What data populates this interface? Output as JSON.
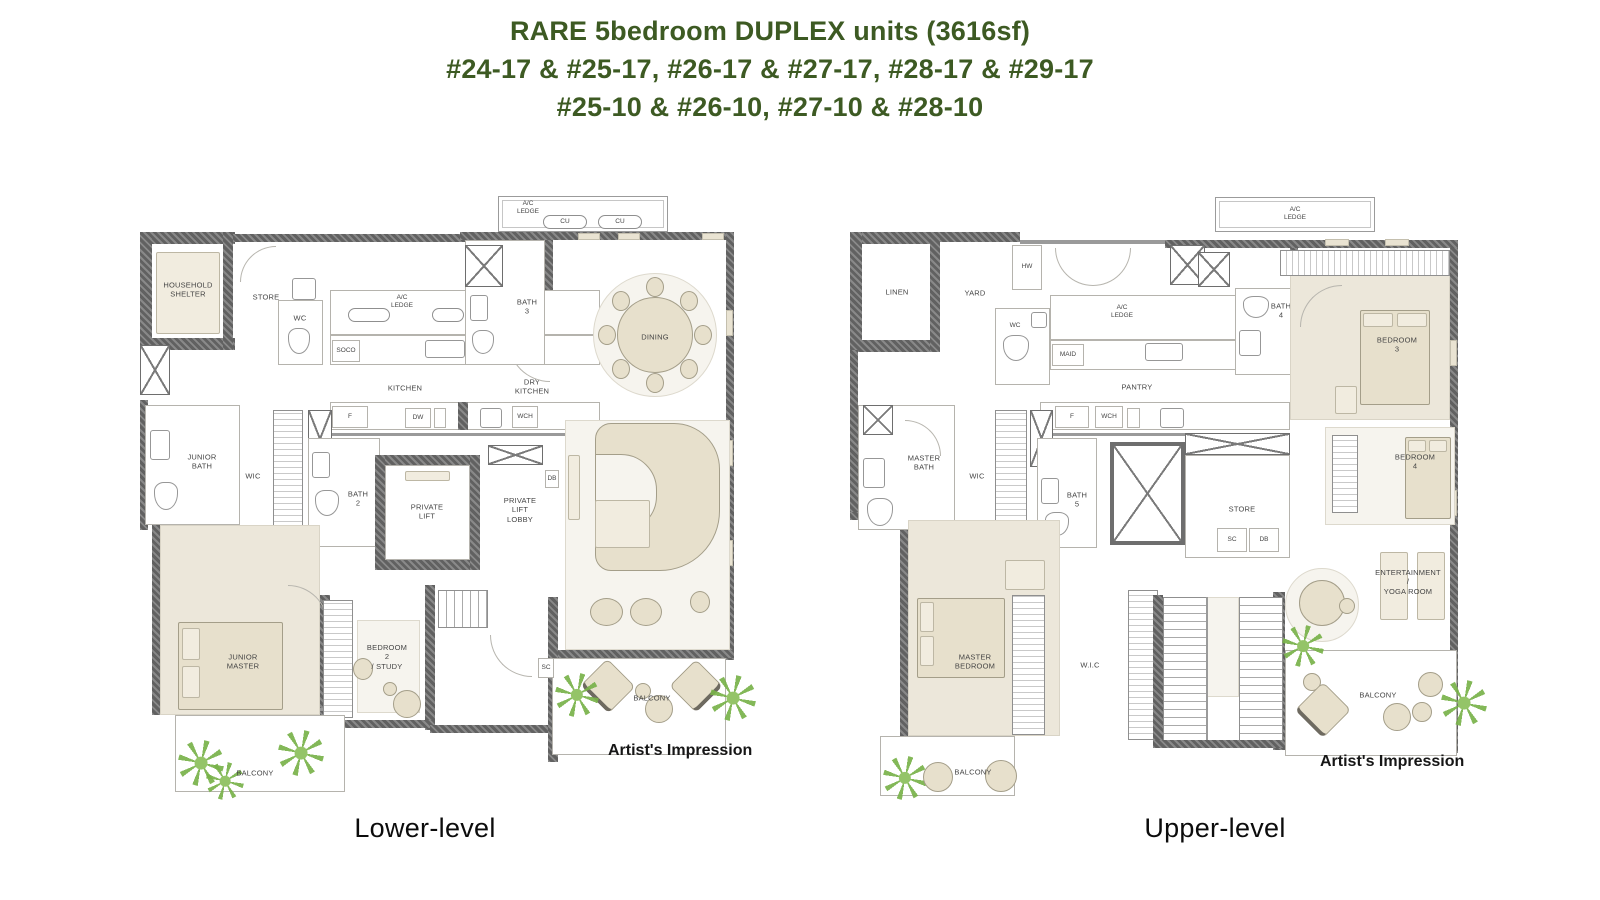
{
  "title": {
    "line1": "RARE 5bedroom DUPLEX units (3616sf)",
    "line2": "#24-17 & #25-17, #26-17 & #27-17, #28-17 & #29-17",
    "line3": "#25-10 & #26-10, #27-10 & #28-10"
  },
  "colors": {
    "title_green": "#3d5a23",
    "wall_gray": "#616161",
    "furniture_beige": "#e7e0cc",
    "floor_beige": "#ece7da",
    "plant_green": "#79b24a",
    "text_dark": "#111111"
  },
  "plans": {
    "lower": {
      "level_label": "Lower-level",
      "credit": "Artist's Impression",
      "rooms": {
        "household_shelter": "HOUSEHOLD\nSHELTER",
        "store": "STORE",
        "wc": "WC",
        "ac_ledge_top": "A/C\nLEDGE",
        "ac_ledge": "A/C\nLEDGE",
        "cu": "CU",
        "soco": "SOCO",
        "kitchen": "KITCHEN",
        "dry_kitchen": "DRY\nKITCHEN",
        "bath_3": "BATH\n3",
        "dining": "DINING",
        "junior_bath": "JUNIOR\nBATH",
        "wic": "WIC",
        "bath_2": "BATH\n2",
        "private_lift": "PRIVATE\nLIFT",
        "private_lift_lobby": "PRIVATE\nLIFT\nLOBBY",
        "db": "DB",
        "f": "F",
        "dw": "DW",
        "wch": "WCH",
        "sc": "SC",
        "junior_master": "JUNIOR\nMASTER",
        "bedroom_2_study": "BEDROOM\n2\n/ STUDY",
        "balcony_left": "BALCONY",
        "balcony_right": "BALCONY"
      }
    },
    "upper": {
      "level_label": "Upper-level",
      "credit": "Artist's Impression",
      "rooms": {
        "linen": "LINEN",
        "yard": "YARD",
        "hw": "HW",
        "wc": "WC",
        "ac_ledge_top": "A/C\nLEDGE",
        "ac_ledge_left": "A/C\nLEDGE",
        "maid": "MAID",
        "pantry": "PANTRY",
        "master_bath": "MASTER\nBATH",
        "wic": "WIC",
        "bath_5": "BATH\n5",
        "f": "F",
        "wch": "WCH",
        "bath_4": "BATH\n4",
        "bedroom_3": "BEDROOM\n3",
        "bedroom_4": "BEDROOM\n4",
        "store": "STORE",
        "sc": "SC",
        "db": "DB",
        "entertainment_yoga": "ENTERTAINMENT\n/\nYOGA ROOM",
        "master_bedroom": "MASTER\nBEDROOM",
        "wic_2": "W.I.C",
        "balcony_left": "BALCONY",
        "balcony_right": "BALCONY"
      }
    }
  }
}
